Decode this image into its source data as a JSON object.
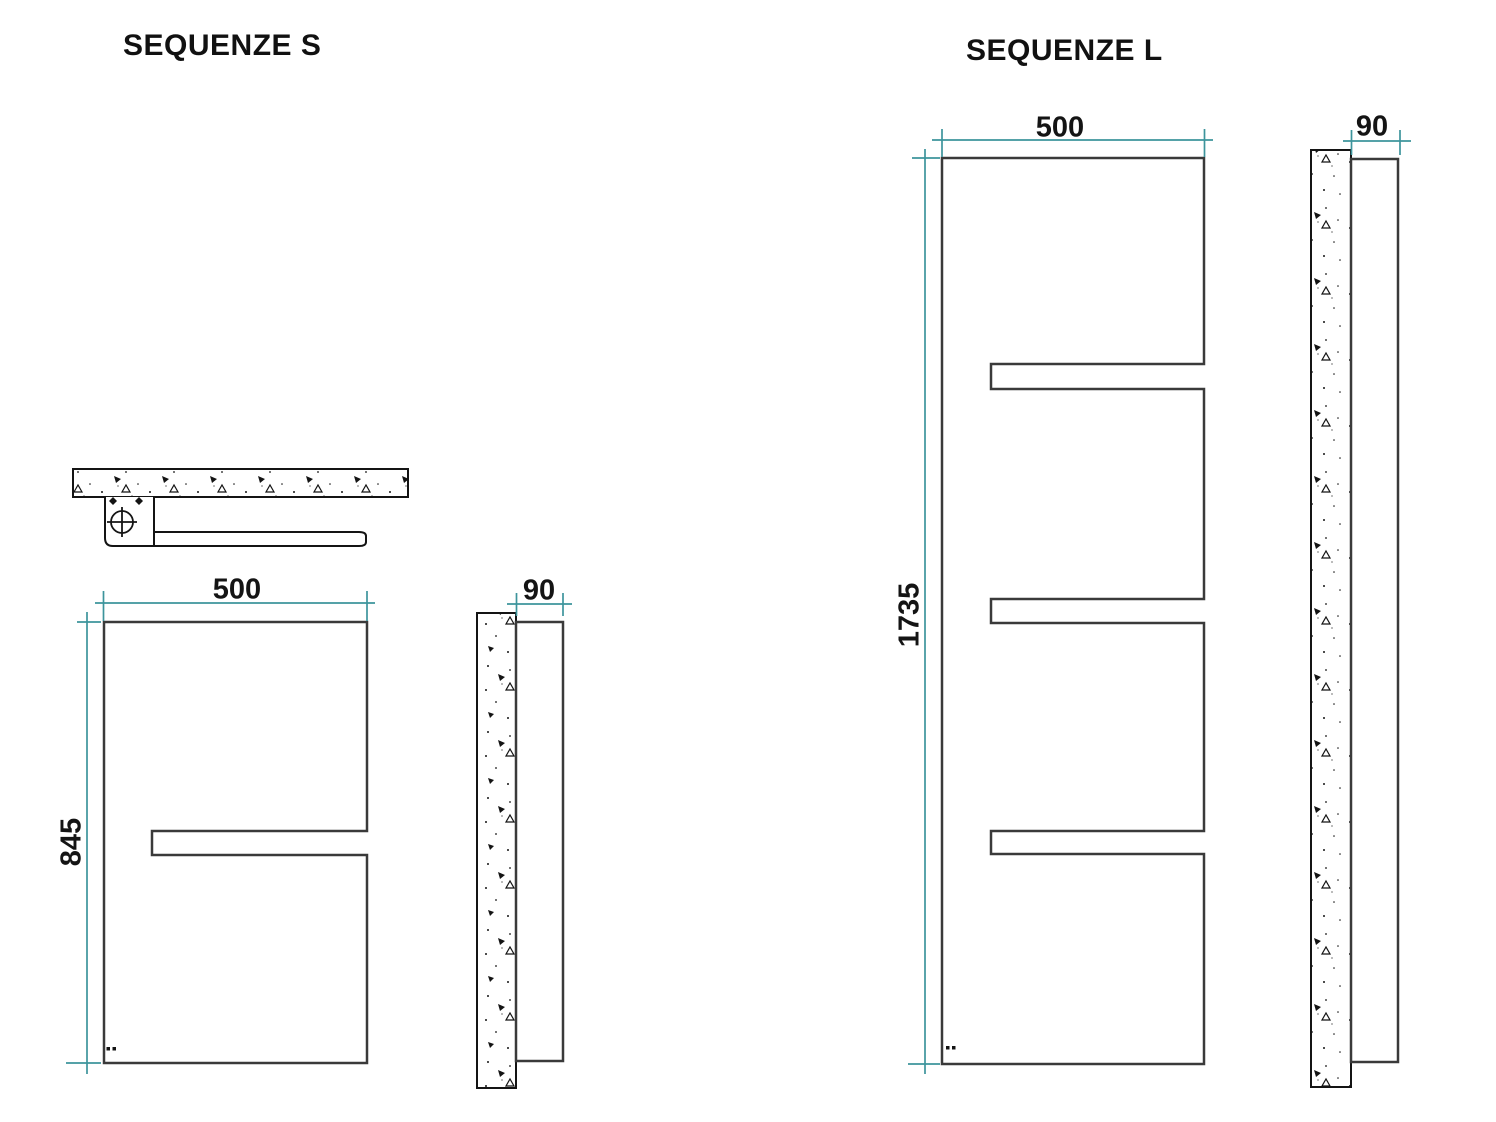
{
  "colors": {
    "dimension_line": "#3d949c",
    "object_line": "#3a3a3a",
    "detail_line": "#141414"
  },
  "figure_s": {
    "title": "SEQUENZE S",
    "dim_width": "500",
    "dim_height": "845",
    "dim_depth": "90"
  },
  "figure_l": {
    "title": "SEQUENZE L",
    "dim_width": "500",
    "dim_height": "1735",
    "dim_depth": "90"
  }
}
